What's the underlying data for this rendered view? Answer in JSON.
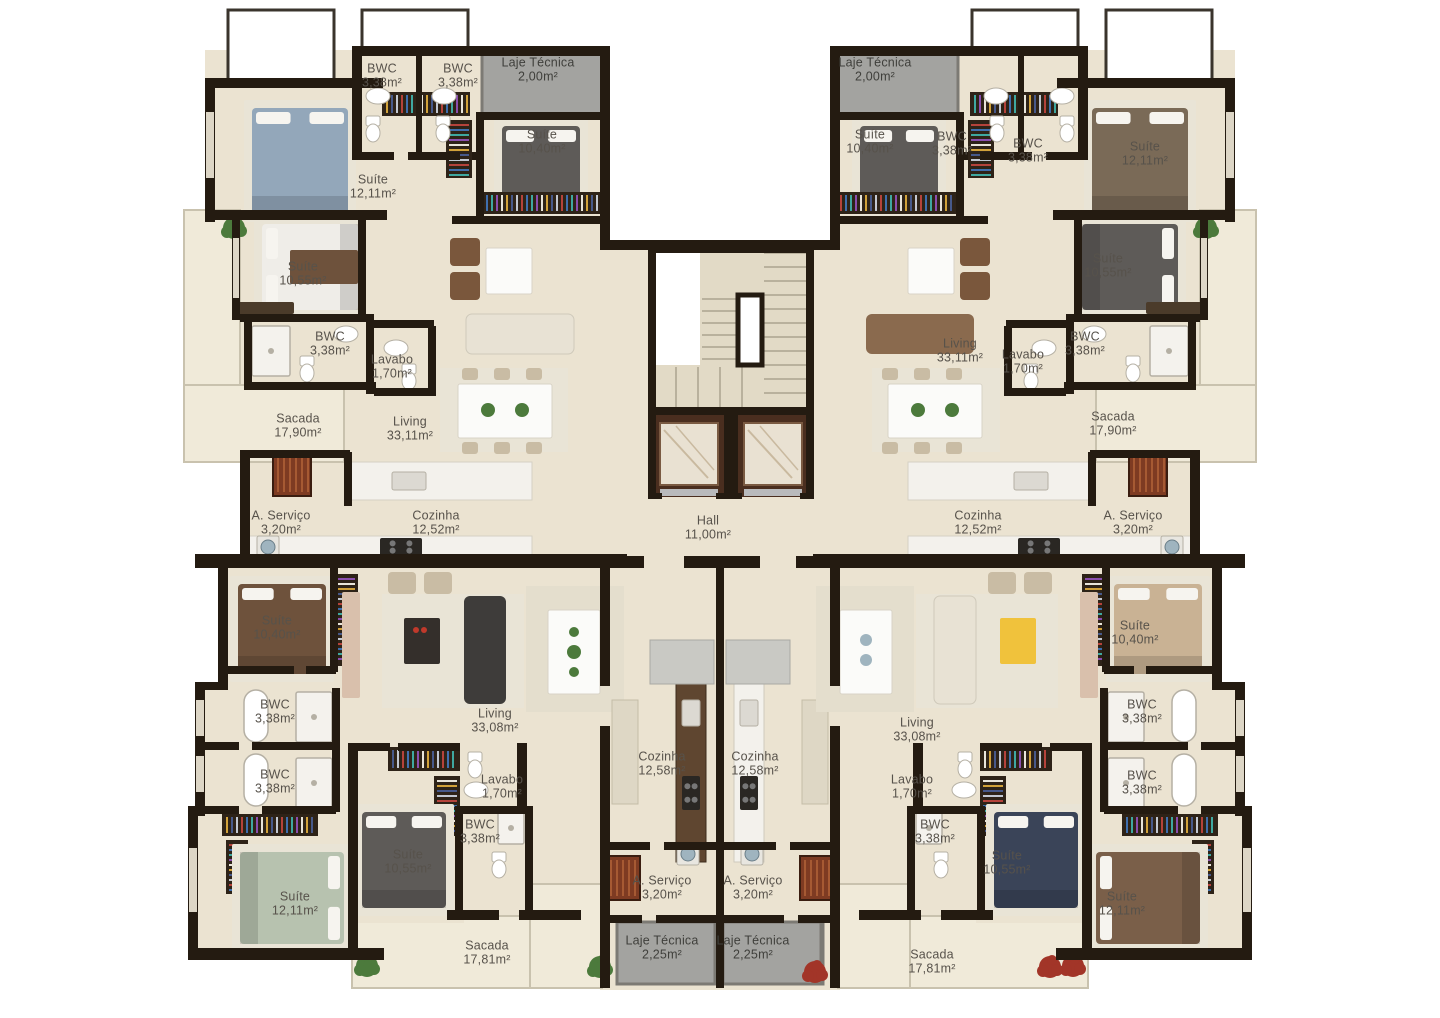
{
  "plan": {
    "type": "residential-floor-plan",
    "units": 4,
    "hall_label": "Hall"
  },
  "colors": {
    "wall": "#241b11",
    "floor": "#ebe3d1",
    "floorLight": "#f0ead9",
    "railing": "#c9c2ae",
    "gray": "#a3a3a0",
    "grayDark": "#7c7a74",
    "label": "#57524b",
    "marble": "#f3f1ec",
    "counterDark": "#5f4630",
    "cabinet": "#ded7c5",
    "elevatorShaft": "#4a2e1f",
    "elevatorCab": "#e9e1d2",
    "elevatorDoor": "#b9babc",
    "wardrobeBase": "#2e2318",
    "bedBlue": "#93a7ba",
    "bedGray": "#5e5b58",
    "bedBrown": "#6e523c",
    "bedTan": "#c9b294",
    "bedSage": "#b7c2af",
    "bedNavy": "#3a4458",
    "bedWhite": "#efede8",
    "sofaCream": "#e8e2d4",
    "sofaCharcoal": "#3e3c3a",
    "armchairBrown": "#7a573c",
    "chairTan": "#c9bca4",
    "tableWhite": "#fbfbf9",
    "rug": "#e9e4d6",
    "steel": "#9fb4bf",
    "plantGreen": "#4c7a3c",
    "plantRed": "#a23528",
    "fixture": "#ffffff",
    "fixtureStroke": "#b5b0a4",
    "tread": "#b9b19d",
    "stairFloor": "#e2dac6",
    "cooktop": "#2a2723"
  },
  "rooms": [
    {
      "name": "BWC",
      "area": "3,38m²",
      "x": 382,
      "y": 76
    },
    {
      "name": "BWC",
      "area": "3,38m²",
      "x": 458,
      "y": 76
    },
    {
      "name": "Laje Técnica",
      "area": "2,00m²",
      "x": 538,
      "y": 70,
      "gray": true
    },
    {
      "name": "Suíte",
      "area": "10,40m²",
      "x": 542,
      "y": 142
    },
    {
      "name": "Suíte",
      "area": "12,11m²",
      "x": 373,
      "y": 187
    },
    {
      "name": "Suíte",
      "area": "10,55m²",
      "x": 303,
      "y": 274
    },
    {
      "name": "BWC",
      "area": "3,38m²",
      "x": 330,
      "y": 344
    },
    {
      "name": "Lavabo",
      "area": "1,70m²",
      "x": 392,
      "y": 367
    },
    {
      "name": "Sacada",
      "area": "17,90m²",
      "x": 298,
      "y": 426
    },
    {
      "name": "Living",
      "area": "33,11m²",
      "x": 410,
      "y": 429
    },
    {
      "name": "A. Serviço",
      "area": "3,20m²",
      "x": 281,
      "y": 523
    },
    {
      "name": "Cozinha",
      "area": "12,52m²",
      "x": 436,
      "y": 523
    },
    {
      "name": "Laje Técnica",
      "area": "2,00m²",
      "x": 875,
      "y": 70,
      "gray": true
    },
    {
      "name": "Suíte",
      "area": "10,40m²",
      "x": 870,
      "y": 142
    },
    {
      "name": "BWC",
      "area": "3,38m²",
      "x": 952,
      "y": 144
    },
    {
      "name": "BWC",
      "area": "3,38m²",
      "x": 1028,
      "y": 151
    },
    {
      "name": "Suíte",
      "area": "12,11m²",
      "x": 1145,
      "y": 154
    },
    {
      "name": "Suíte",
      "area": "10,55m²",
      "x": 1108,
      "y": 266
    },
    {
      "name": "BWC",
      "area": "3,38m²",
      "x": 1085,
      "y": 344
    },
    {
      "name": "Lavabo",
      "area": "1,70m²",
      "x": 1023,
      "y": 362
    },
    {
      "name": "Living",
      "area": "33,11m²",
      "x": 960,
      "y": 351
    },
    {
      "name": "Sacada",
      "area": "17,90m²",
      "x": 1113,
      "y": 424
    },
    {
      "name": "Cozinha",
      "area": "12,52m²",
      "x": 978,
      "y": 523
    },
    {
      "name": "A. Serviço",
      "area": "3,20m²",
      "x": 1133,
      "y": 523
    },
    {
      "name": "Hall",
      "area": "11,00m²",
      "x": 708,
      "y": 528
    },
    {
      "name": "Suíte",
      "area": "10,40m²",
      "x": 277,
      "y": 628
    },
    {
      "name": "BWC",
      "area": "3,38m²",
      "x": 275,
      "y": 712
    },
    {
      "name": "BWC",
      "area": "3,38m²",
      "x": 275,
      "y": 782
    },
    {
      "name": "Suíte",
      "area": "12,11m²",
      "x": 295,
      "y": 904
    },
    {
      "name": "Suíte",
      "area": "10,55m²",
      "x": 408,
      "y": 862
    },
    {
      "name": "BWC",
      "area": "3,38m²",
      "x": 480,
      "y": 832
    },
    {
      "name": "Lavabo",
      "area": "1,70m²",
      "x": 502,
      "y": 787
    },
    {
      "name": "Living",
      "area": "33,08m²",
      "x": 495,
      "y": 721
    },
    {
      "name": "Cozinha",
      "area": "12,58m²",
      "x": 662,
      "y": 764
    },
    {
      "name": "A. Serviço",
      "area": "3,20m²",
      "x": 662,
      "y": 888
    },
    {
      "name": "Laje Técnica",
      "area": "2,25m²",
      "x": 662,
      "y": 948,
      "gray": true
    },
    {
      "name": "Sacada",
      "area": "17,81m²",
      "x": 487,
      "y": 953
    },
    {
      "name": "Suíte",
      "area": "10,40m²",
      "x": 1135,
      "y": 633
    },
    {
      "name": "BWC",
      "area": "3,38m²",
      "x": 1142,
      "y": 712
    },
    {
      "name": "BWC",
      "area": "3,38m²",
      "x": 1142,
      "y": 783
    },
    {
      "name": "Suíte",
      "area": "12,11m²",
      "x": 1122,
      "y": 904
    },
    {
      "name": "Suíte",
      "area": "10,55m²",
      "x": 1007,
      "y": 863
    },
    {
      "name": "BWC",
      "area": "3,38m²",
      "x": 935,
      "y": 832
    },
    {
      "name": "Lavabo",
      "area": "1,70m²",
      "x": 912,
      "y": 787
    },
    {
      "name": "Living",
      "area": "33,08m²",
      "x": 917,
      "y": 730
    },
    {
      "name": "Cozinha",
      "area": "12,58m²",
      "x": 755,
      "y": 764
    },
    {
      "name": "A. Serviço",
      "area": "3,20m²",
      "x": 753,
      "y": 888
    },
    {
      "name": "Laje Técnica",
      "area": "2,25m²",
      "x": 753,
      "y": 948,
      "gray": true
    },
    {
      "name": "Sacada",
      "area": "17,81m²",
      "x": 932,
      "y": 962
    }
  ]
}
